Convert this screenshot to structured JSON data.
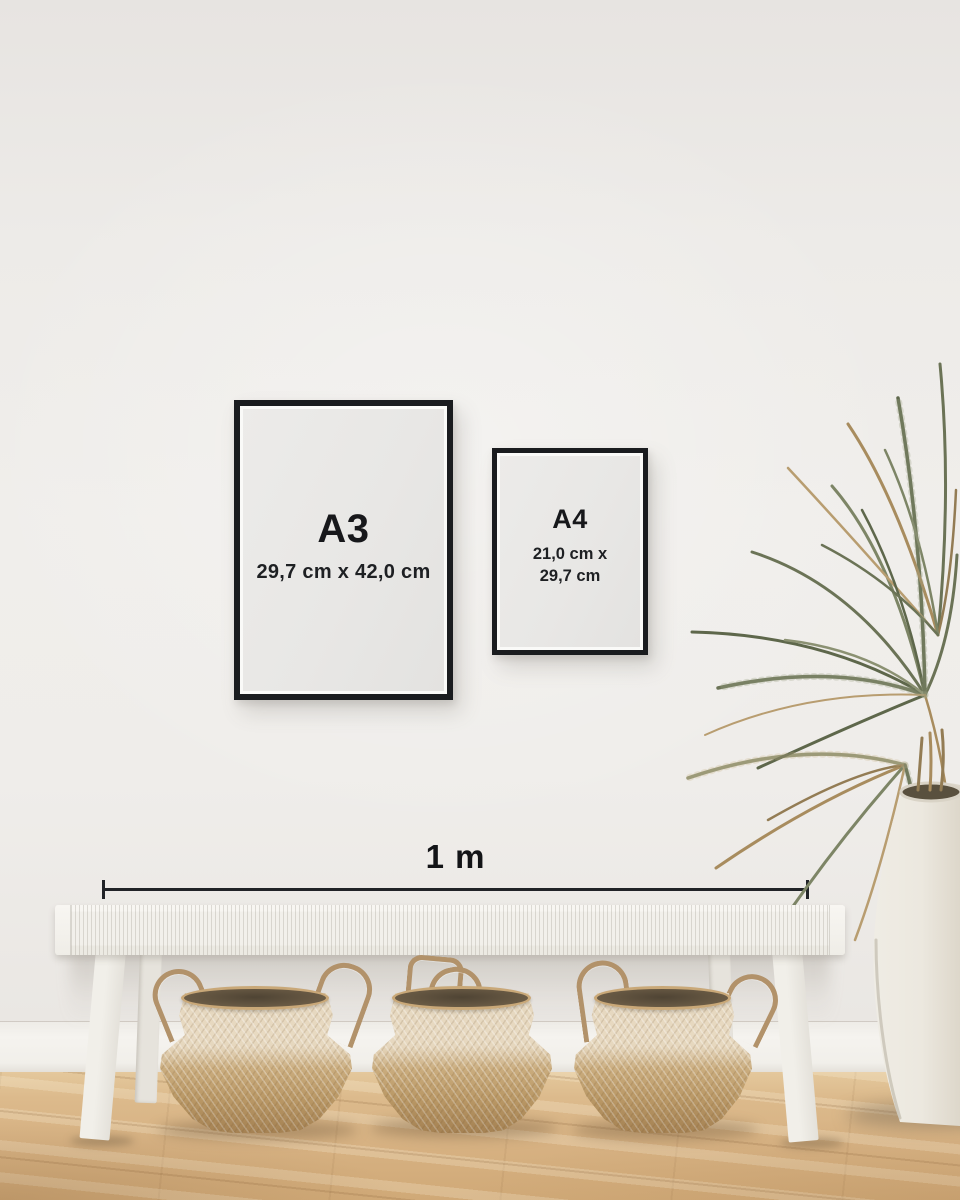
{
  "frames": {
    "a3": {
      "label": "A3",
      "size": "29,7 cm x 42,0 cm"
    },
    "a4": {
      "label": "A4",
      "size_line1": "21,0 cm x",
      "size_line2": "29,7 cm"
    }
  },
  "measure": {
    "label": "1 m"
  },
  "colors": {
    "frame_black": "#1a1c1f",
    "paper": "#e9e8e6",
    "wall": "#efedea",
    "baseboard": "#f3f1ed",
    "floor_oak": "#d9b586",
    "basket_tan": "#c9ab7c",
    "bench_white": "#f2f0eb",
    "plant_green": "#6b7356",
    "plant_dry": "#a88c5e",
    "vase_cream": "#eeebe3",
    "text": "#17181b"
  },
  "objects": {
    "frame_a3": "black picture frame showing A3 size",
    "frame_a4": "black picture frame showing A4 size",
    "scale_bar": "1 metre reference scale",
    "bench": "white woven bench",
    "baskets": "three seagrass belly baskets",
    "plant": "dried palm plant",
    "vase": "large white ceramic floor vase",
    "floor": "light oak wood floor"
  }
}
